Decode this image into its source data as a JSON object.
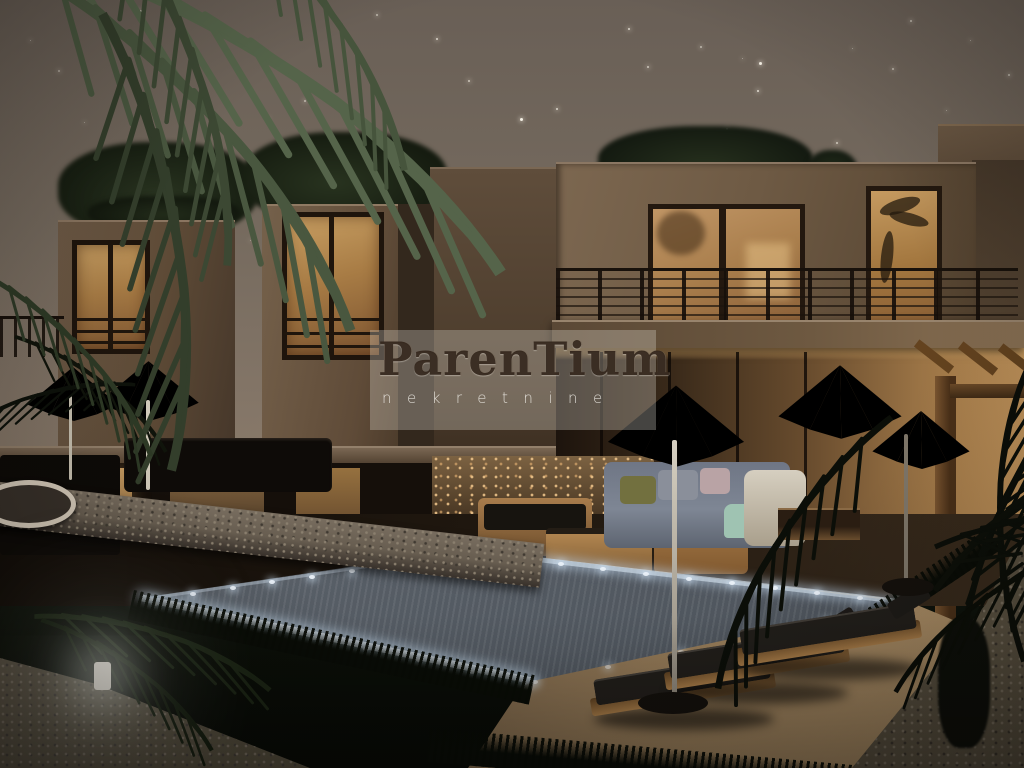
{
  "watermark": {
    "brand": "ParenTium",
    "subtitle": "nekretnine",
    "brand_color": "#30221880",
    "subtitle_color": "#f6f4ee",
    "box_color": "rgba(228,224,216,0.30)"
  },
  "scene": {
    "type": "architectural-night-render",
    "subject": "modern-cubic-villas-with-pool-at-night",
    "palette": {
      "sky_top": "#695f56",
      "sky_horizon": "#95826e",
      "wall_lit": "#7c6750",
      "wall_shadow": "#31251a",
      "window_glow": "#c79e62",
      "interior_glow": "#c3955c",
      "water": "#5a6169",
      "led_light": "#eef5fc",
      "grass": "#0b0f08",
      "deck": "#9a7f5b",
      "umbrella_canopy": "#7b7e6b",
      "palm_silhouette": "#0c0e09",
      "stone_wall": "#675d50",
      "gravel": "#4c4537"
    },
    "stars": [
      [
        140,
        10,
        2,
        0.7
      ],
      [
        204,
        16,
        1,
        0.5
      ],
      [
        376,
        14,
        2,
        0.6
      ],
      [
        436,
        38,
        2,
        0.8
      ],
      [
        468,
        80,
        2,
        0.7
      ],
      [
        520,
        118,
        3,
        1
      ],
      [
        556,
        108,
        2,
        0.8
      ],
      [
        628,
        28,
        2,
        0.8
      ],
      [
        647,
        66,
        2,
        0.7
      ],
      [
        700,
        46,
        2,
        0.6
      ],
      [
        742,
        58,
        1,
        0.5
      ],
      [
        759,
        62,
        3,
        0.95
      ],
      [
        757,
        90,
        2,
        0.85
      ],
      [
        726,
        128,
        2,
        0.6
      ],
      [
        836,
        142,
        2,
        0.7
      ],
      [
        852,
        48,
        1,
        0.5
      ],
      [
        892,
        68,
        2,
        0.6
      ],
      [
        918,
        200,
        2,
        0.6
      ],
      [
        946,
        110,
        1,
        0.5
      ],
      [
        973,
        128,
        2,
        0.65
      ],
      [
        1008,
        74,
        2,
        0.6
      ],
      [
        1014,
        136,
        1,
        0.5
      ],
      [
        268,
        118,
        1,
        0.5
      ],
      [
        304,
        100,
        2,
        0.6
      ],
      [
        362,
        154,
        1,
        0.5
      ],
      [
        402,
        208,
        2,
        0.55
      ],
      [
        460,
        246,
        1,
        0.45
      ],
      [
        530,
        210,
        1,
        0.5
      ],
      [
        610,
        236,
        1,
        0.45
      ],
      [
        668,
        162,
        2,
        0.55
      ],
      [
        712,
        230,
        1,
        0.45
      ],
      [
        760,
        152,
        1,
        0.5
      ],
      [
        660,
        300,
        1,
        0.4
      ],
      [
        700,
        332,
        1,
        0.4
      ],
      [
        580,
        330,
        1,
        0.35
      ],
      [
        250,
        240,
        1,
        0.4
      ],
      [
        215,
        300,
        1,
        0.35
      ],
      [
        110,
        330,
        1,
        0.35
      ],
      [
        318,
        282,
        1,
        0.35
      ],
      [
        860,
        240,
        1,
        0.45
      ],
      [
        902,
        302,
        1,
        0.4
      ],
      [
        955,
        280,
        1,
        0.4
      ],
      [
        995,
        328,
        1,
        0.35
      ],
      [
        840,
        332,
        1,
        0.35
      ],
      [
        58,
        70,
        2,
        0.5
      ],
      [
        84,
        122,
        1,
        0.45
      ],
      [
        30,
        40,
        1,
        0.5
      ],
      [
        910,
        20,
        2,
        0.6
      ],
      [
        970,
        40,
        1,
        0.5
      ],
      [
        545,
        300,
        1,
        0.35
      ]
    ],
    "pool": {
      "outline": [
        [
          147,
          597
        ],
        [
          470,
          549
        ],
        [
          905,
          602
        ],
        [
          528,
          682
        ]
      ],
      "led_edges": [
        {
          "from": [
            150,
            598
          ],
          "to": [
            468,
            551
          ],
          "count": 9,
          "opacity": 0.95
        },
        {
          "from": [
            152,
            602
          ],
          "to": [
            522,
            681
          ],
          "count": 8,
          "opacity": 1
        },
        {
          "from": [
            472,
            552
          ],
          "to": [
            900,
            601
          ],
          "count": 11,
          "opacity": 0.9
        },
        {
          "from": [
            896,
            604
          ],
          "to": [
            532,
            680
          ],
          "count": 6,
          "opacity": 0.55
        }
      ]
    }
  }
}
